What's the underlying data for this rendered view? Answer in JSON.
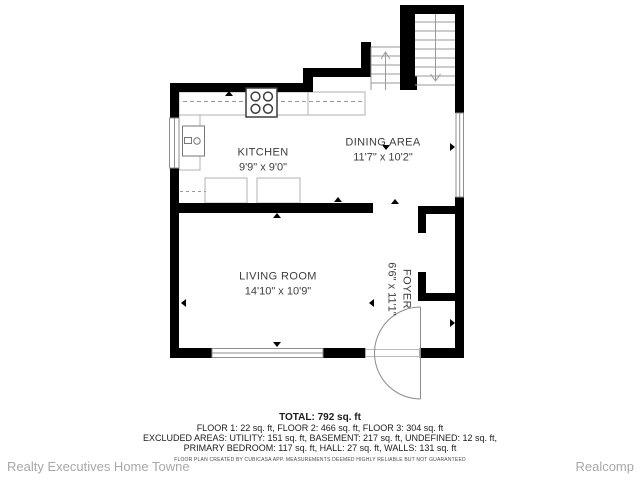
{
  "floor_plan": {
    "rooms": [
      {
        "name": "KITCHEN",
        "dimensions": "9'9\" x 9'0\""
      },
      {
        "name": "DINING AREA",
        "dimensions": "11'7\" x 10'2\""
      },
      {
        "name": "LIVING ROOM",
        "dimensions": "14'10\" x 10'9\""
      },
      {
        "name": "FOYER",
        "dimensions": "6'6\" x 11'1\""
      }
    ],
    "fixtures": [
      "stove",
      "kitchen-sink",
      "counter",
      "upper-cabinets",
      "base-cabinets",
      "closet",
      "entry-door",
      "windows"
    ],
    "icons": {
      "stairs_up": "up-arrow",
      "stairs_down": "down-arrow"
    },
    "summary": {
      "total": "TOTAL: 792 sq. ft",
      "floors": "FLOOR 1: 22 sq. ft, FLOOR 2: 466 sq. ft, FLOOR 3: 304 sq. ft",
      "excluded_1": "EXCLUDED AREAS: UTILITY: 151 sq. ft, BASEMENT: 217 sq. ft, UNDEFINED: 12 sq. ft,",
      "excluded_2": "PRIMARY BEDROOM: 117 sq. ft, HALL: 27 sq. ft, WALLS: 131 sq. ft",
      "disclaimer": "FLOOR PLAN CREATED BY CUBICASA APP. MEASUREMENTS DEEMED HIGHLY RELIABLE BUT NOT GUARANTEED"
    },
    "footer": {
      "left": "Realty Executives Home Towne",
      "right": "Realcomp"
    },
    "colors": {
      "wall": "#000000",
      "fixture_line": "#9a9a9a",
      "label_text": "#3d3d3d",
      "summary_text": "#1b1b1b",
      "footer_text": "#a8a8a8",
      "background": "#ffffff"
    }
  }
}
